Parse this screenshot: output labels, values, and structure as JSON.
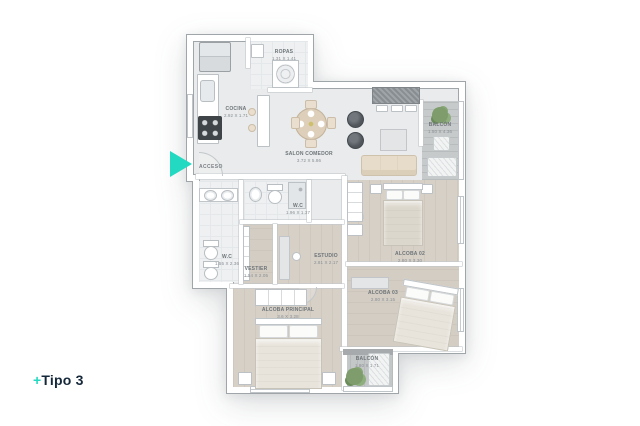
{
  "branding": {
    "title_prefix": "+",
    "title": "Tipo 3",
    "accent_color": "#24D9C1",
    "title_color": "#15283A"
  },
  "entrance": {
    "label": "ACCESO"
  },
  "rooms": {
    "ropas": {
      "name": "ROPAS",
      "dims": "1.31 X 1.41"
    },
    "cocina": {
      "name": "COCINA",
      "dims": "2.92 X 1.71"
    },
    "salon_comedor": {
      "name": "SALON COMEDOR",
      "dims": "3.72 X 5.86"
    },
    "balcon_superior": {
      "name": "BALCÓN",
      "dims": "1.50 X 4.36"
    },
    "wc_social": {
      "name": "W.C",
      "dims": "1.96 X 1.37"
    },
    "wc_principal": {
      "name": "W.C",
      "dims": "1.55 X 2.36"
    },
    "vestier": {
      "name": "VESTIER",
      "dims": "1.54 X 2.05"
    },
    "estudio": {
      "name": "ESTUDIO",
      "dims": "2.81 X 2.17"
    },
    "alcoba_02": {
      "name": "ALCOBA 02",
      "dims": "2.80 X 3.30"
    },
    "alcoba_03": {
      "name": "ALCOBA 03",
      "dims": "2.80 X 3.15"
    },
    "alcoba_principal": {
      "name": "ALCOBA PRINCIPAL",
      "dims": "3.6 X 3.28"
    },
    "balcon_inferior": {
      "name": "BALCÓN",
      "dims": "1.80 X 1.71"
    }
  },
  "icons": {
    "entrance-marker-icon": "right-pointing-triangle",
    "fridge-icon": "refrigerator-top-view",
    "stove-icon": "cooktop-4-burners",
    "sink-icon": "kitchen-sink",
    "washer-icon": "washing-machine-top",
    "dining-table-icon": "round-table-4-chairs",
    "armchair-icon": "round-armchair",
    "desk-icon": "hatched-desk-with-chairs",
    "tv-cabinet-icon": "media-cabinet",
    "sofa-icon": "three-seat-sofa",
    "plant-icon": "potted-plant",
    "lounge-chair-icon": "outdoor-lounge-chair",
    "bed-icon": "double-bed-top-view",
    "wardrobe-icon": "wardrobe-with-shelves",
    "nightstand-icon": "nightstand",
    "toilet-icon": "toilet-top-view",
    "vanity-icon": "double-sink-vanity",
    "shower-icon": "shower-cabin",
    "door-icon": "door-swing-arc",
    "window-icon": "window-double-line"
  },
  "colors": {
    "accent": "#24D9C1",
    "title_text": "#15283A",
    "floor_tile": "#E9EBEC",
    "floor_wood": "#D6D0C7",
    "balcony_floor": "#C7CACB",
    "wall": "#FFFFFF",
    "label_text": "#6E7478"
  }
}
